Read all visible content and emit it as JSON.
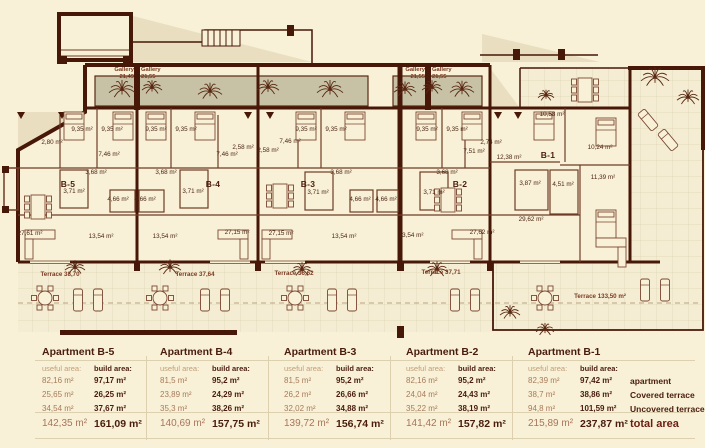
{
  "plan": {
    "colors": {
      "wall": "#471708",
      "partition": "#6f3c26",
      "planter": "#c7c2a6",
      "shadow": "#eadec0",
      "terrace": "#f4edd3",
      "grid": "#ded3b2",
      "furniture": "#7a4631",
      "label": "#4a2414"
    },
    "labels": [
      {
        "t": "Gallery",
        "x": 134,
        "y": 71,
        "cls": "gal",
        "a": "end"
      },
      {
        "t": "21,49",
        "x": 134,
        "y": 78,
        "cls": "gal",
        "a": "end"
      },
      {
        "t": "Gallery",
        "x": 141,
        "y": 71,
        "cls": "gal",
        "a": "start"
      },
      {
        "t": "21,55",
        "x": 141,
        "y": 78,
        "cls": "gal",
        "a": "start"
      },
      {
        "t": "Gallery",
        "x": 425,
        "y": 71,
        "cls": "gal",
        "a": "end"
      },
      {
        "t": "21,55",
        "x": 425,
        "y": 78,
        "cls": "gal",
        "a": "end"
      },
      {
        "t": "Gallery",
        "x": 432,
        "y": 71,
        "cls": "gal",
        "a": "start"
      },
      {
        "t": "21,55",
        "x": 432,
        "y": 78,
        "cls": "gal",
        "a": "start"
      },
      {
        "t": "9,35 m²",
        "x": 82,
        "y": 131,
        "cls": "room"
      },
      {
        "t": "9,35 m²",
        "x": 112,
        "y": 131,
        "cls": "room"
      },
      {
        "t": "9,35 m²",
        "x": 156,
        "y": 131,
        "cls": "room"
      },
      {
        "t": "9,35 m²",
        "x": 186,
        "y": 131,
        "cls": "room"
      },
      {
        "t": "9,35 m²",
        "x": 306,
        "y": 131,
        "cls": "room"
      },
      {
        "t": "9,35 m²",
        "x": 336,
        "y": 131,
        "cls": "room"
      },
      {
        "t": "9,35 m²",
        "x": 427,
        "y": 131,
        "cls": "room"
      },
      {
        "t": "9,35 m²",
        "x": 457,
        "y": 131,
        "cls": "room"
      },
      {
        "t": "2,80 m²",
        "x": 52,
        "y": 144,
        "cls": "room"
      },
      {
        "t": "7,46 m²",
        "x": 109,
        "y": 156,
        "cls": "room"
      },
      {
        "t": "7,46 m²",
        "x": 227,
        "y": 156,
        "cls": "room"
      },
      {
        "t": "7,46 m²",
        "x": 290,
        "y": 143,
        "cls": "room"
      },
      {
        "t": "2,58 m²",
        "x": 243,
        "y": 149,
        "cls": "room"
      },
      {
        "t": "2,58 m²",
        "x": 268,
        "y": 152,
        "cls": "room"
      },
      {
        "t": "2,74 m²",
        "x": 491,
        "y": 144,
        "cls": "room"
      },
      {
        "t": "7,51 m²",
        "x": 474,
        "y": 153,
        "cls": "room"
      },
      {
        "t": "3,68 m²",
        "x": 96,
        "y": 174,
        "cls": "room"
      },
      {
        "t": "3,68 m²",
        "x": 166,
        "y": 174,
        "cls": "room"
      },
      {
        "t": "3,68 m²",
        "x": 341,
        "y": 174,
        "cls": "room"
      },
      {
        "t": "3,68 m²",
        "x": 447,
        "y": 174,
        "cls": "room"
      },
      {
        "t": "3,71 m²",
        "x": 74,
        "y": 193,
        "cls": "room"
      },
      {
        "t": "3,71 m²",
        "x": 193,
        "y": 193,
        "cls": "room"
      },
      {
        "t": "3,71 m²",
        "x": 318,
        "y": 194,
        "cls": "room"
      },
      {
        "t": "3,71 m²",
        "x": 434,
        "y": 194,
        "cls": "room"
      },
      {
        "t": "4,66 m²",
        "x": 118,
        "y": 201,
        "cls": "room"
      },
      {
        "t": "4,66 m²",
        "x": 145,
        "y": 201,
        "cls": "room"
      },
      {
        "t": "4,66 m²",
        "x": 360,
        "y": 201,
        "cls": "room"
      },
      {
        "t": "4,66 m²",
        "x": 386,
        "y": 201,
        "cls": "room"
      },
      {
        "t": "13,54 m²",
        "x": 101,
        "y": 238,
        "cls": "room"
      },
      {
        "t": "13,54 m²",
        "x": 165,
        "y": 238,
        "cls": "room"
      },
      {
        "t": "13,54 m²",
        "x": 344,
        "y": 238,
        "cls": "room"
      },
      {
        "t": "13,54 m²",
        "x": 411,
        "y": 237,
        "cls": "room"
      },
      {
        "t": "27,61 m²",
        "x": 30,
        "y": 235,
        "cls": "room"
      },
      {
        "t": "27,15 m²",
        "x": 237,
        "y": 234,
        "cls": "room"
      },
      {
        "t": "27,15 m²",
        "x": 281,
        "y": 235,
        "cls": "room"
      },
      {
        "t": "27,62 m²",
        "x": 482,
        "y": 234,
        "cls": "room"
      },
      {
        "t": "B-5",
        "x": 68,
        "y": 187,
        "cls": "apt"
      },
      {
        "t": "B-4",
        "x": 213,
        "y": 187,
        "cls": "apt"
      },
      {
        "t": "B-3",
        "x": 308,
        "y": 187,
        "cls": "apt"
      },
      {
        "t": "B-2",
        "x": 460,
        "y": 187,
        "cls": "apt"
      },
      {
        "t": "B-1",
        "x": 548,
        "y": 158,
        "cls": "apt"
      },
      {
        "t": "10,58 m²",
        "x": 552,
        "y": 116,
        "cls": "room"
      },
      {
        "t": "10,24 m²",
        "x": 600,
        "y": 149,
        "cls": "room"
      },
      {
        "t": "12,38 m²",
        "x": 509,
        "y": 159,
        "cls": "room"
      },
      {
        "t": "11,39 m²",
        "x": 603,
        "y": 179,
        "cls": "room"
      },
      {
        "t": "3,87 m²",
        "x": 530,
        "y": 185,
        "cls": "room"
      },
      {
        "t": "4,51 m²",
        "x": 563,
        "y": 186,
        "cls": "room"
      },
      {
        "t": "29,62 m²",
        "x": 531,
        "y": 221,
        "cls": "room"
      },
      {
        "t": "Terrace  38,70",
        "x": 60,
        "y": 276,
        "cls": "ter"
      },
      {
        "t": "Terrace  37,64",
        "x": 195,
        "y": 276,
        "cls": "ter"
      },
      {
        "t": "Terrace  36,62",
        "x": 294,
        "y": 275,
        "cls": "ter"
      },
      {
        "t": "Terrace  37,71",
        "x": 441,
        "y": 274,
        "cls": "ter"
      },
      {
        "t": "Terrace  133,50 m²",
        "x": 600,
        "y": 298,
        "cls": "ter"
      }
    ]
  },
  "tables": {
    "columns": [
      {
        "title": "Apartment B-5",
        "useful_header": "useful area:",
        "build_header": "build area:",
        "useful": [
          "82,16 m²",
          "25,65 m²",
          "34,54 m²"
        ],
        "build": [
          "97,17 m²",
          "26,25 m²",
          "37,67 m²"
        ],
        "useful_total": "142,35 m²",
        "build_total": "161,09 m²"
      },
      {
        "title": "Apartment B-4",
        "useful_header": "useful area:",
        "build_header": "build area:",
        "useful": [
          "81,5 m²",
          "23,89 m²",
          "35,3 m²"
        ],
        "build": [
          "95,2 m²",
          "24,29 m²",
          "38,26 m²"
        ],
        "useful_total": "140,69 m²",
        "build_total": "157,75 m²"
      },
      {
        "title": "Apartment B-3",
        "useful_header": "useful area:",
        "build_header": "build area:",
        "useful": [
          "81,5 m²",
          "26,2 m²",
          "32,02 m²"
        ],
        "build": [
          "95,2 m²",
          "26,66 m²",
          "34,88 m²"
        ],
        "useful_total": "139,72 m²",
        "build_total": "156,74 m²"
      },
      {
        "title": "Apartment B-2",
        "useful_header": "useful area:",
        "build_header": "build area:",
        "useful": [
          "82,16 m²",
          "24,04 m²",
          "35,22 m²"
        ],
        "build": [
          "95,2 m²",
          "24,43 m²",
          "38,19 m²"
        ],
        "useful_total": "141,42 m²",
        "build_total": "157,82 m²"
      },
      {
        "title": "Apartment B-1",
        "useful_header": "useful area:",
        "build_header": "build area:",
        "useful": [
          "82,39 m²",
          "38,7 m²",
          "94,8 m²"
        ],
        "build": [
          "97,42 m²",
          "38,86 m²",
          "101,59 m²"
        ],
        "useful_total": "215,89 m²",
        "build_total": "237,87 m²"
      }
    ],
    "row_labels": [
      "apartment",
      "Covered terrace",
      "Uncovered terrace"
    ],
    "total_label": "total area"
  }
}
